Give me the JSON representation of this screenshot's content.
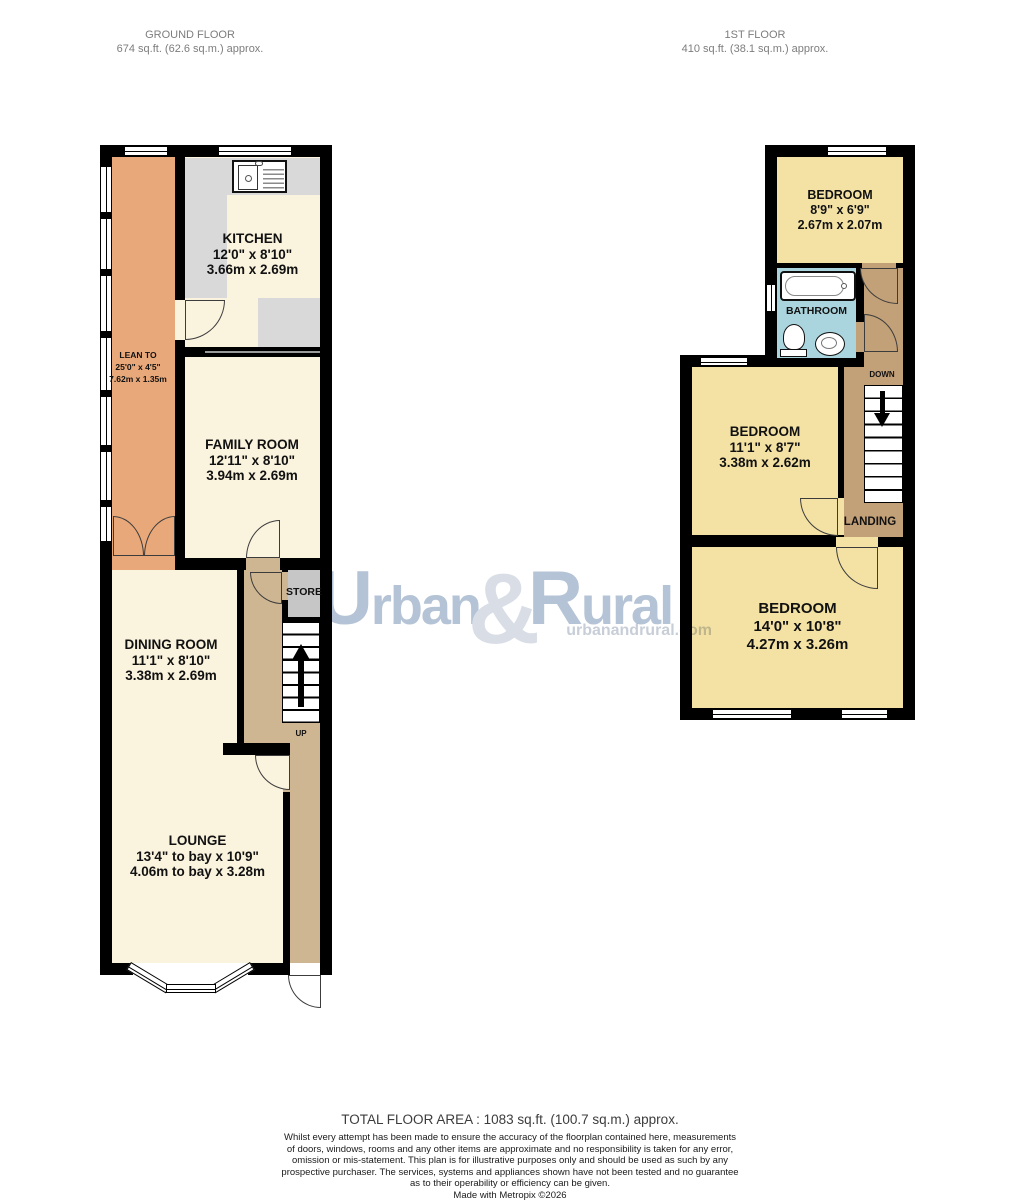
{
  "header": {
    "ground_floor_title": "GROUND FLOOR",
    "ground_floor_area": "674 sq.ft. (62.6 sq.m.) approx.",
    "first_floor_title": "1ST FLOOR",
    "first_floor_area": "410 sq.ft. (38.1 sq.m.) approx."
  },
  "gf": {
    "kitchen": {
      "name": "KITCHEN",
      "imperial": "12'0\" x 8'10\"",
      "metric": "3.66m x 2.69m"
    },
    "lean_to": {
      "name": "LEAN TO",
      "imperial": "25'0\" x 4'5\"",
      "metric": "7.62m x 1.35m"
    },
    "family_room": {
      "name": "FAMILY ROOM",
      "imperial": "12'11\" x 8'10\"",
      "metric": "3.94m x 2.69m"
    },
    "dining_room": {
      "name": "DINING ROOM",
      "imperial": "11'1\" x 8'10\"",
      "metric": "3.38m x 2.69m"
    },
    "lounge": {
      "name": "LOUNGE",
      "imperial": "13'4\" to bay x 10'9\"",
      "metric": "4.06m to bay x 3.28m"
    },
    "store": {
      "name": "STORE"
    },
    "up_label": "UP"
  },
  "ff": {
    "bedroom_small": {
      "name": "BEDROOM",
      "imperial": "8'9\" x 6'9\"",
      "metric": "2.67m x 2.07m"
    },
    "bedroom_mid": {
      "name": "BEDROOM",
      "imperial": "11'1\" x 8'7\"",
      "metric": "3.38m x 2.62m"
    },
    "bedroom_large": {
      "name": "BEDROOM",
      "imperial": "14'0\" x 10'8\"",
      "metric": "4.27m x 3.26m"
    },
    "bathroom": {
      "name": "BATHROOM"
    },
    "landing": {
      "name": "LANDING"
    },
    "down_label": "DOWN"
  },
  "watermark": {
    "part1": "Urban",
    "amp": "&",
    "part2": "Rural",
    "url": "urbanandrural.com"
  },
  "footer": {
    "total_area": "TOTAL FLOOR AREA : 1083 sq.ft. (100.7 sq.m.) approx.",
    "disclaimer_lines": [
      "Whilst every attempt has been made to ensure the accuracy of the floorplan contained here, measurements",
      "of doors, windows, rooms and any other items are approximate and no responsibility is taken for any error,",
      "omission or mis-statement. This plan is for illustrative purposes only and should be used as such by any",
      "prospective purchaser. The services, systems and appliances shown have not been tested and no guarantee",
      "as to their operability or efficiency can be given."
    ],
    "credit": "Made with Metropix ©2026"
  },
  "colors": {
    "wall": "#000000",
    "room_cream": "#faf3de",
    "lean_to_orange": "#e8a87a",
    "hall_tan": "#cfb693",
    "landing_tan": "#c2a078",
    "bedroom_yellow": "#f4e2a5",
    "bathroom_blue": "#abd5de",
    "counter_grey": "#d9d9d9",
    "store_grey": "#c6c6c6",
    "watermark_blue": "#b4c3d5"
  }
}
